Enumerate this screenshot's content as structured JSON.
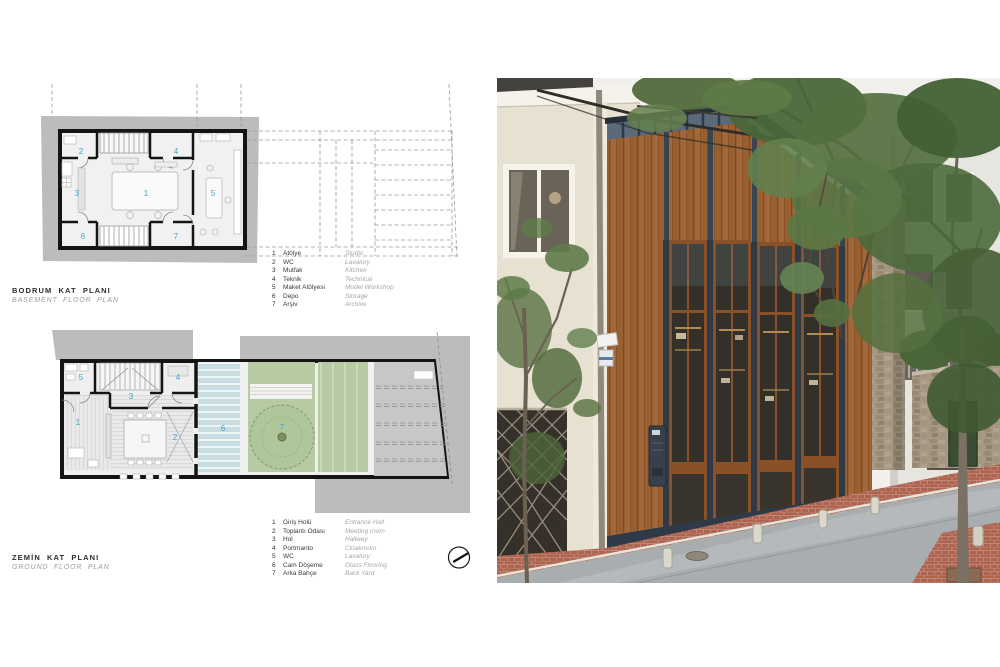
{
  "titles": {
    "basement_tr": "BODRUM KAT PLANI",
    "basement_en": "BASEMENT FLOOR PLAN",
    "ground_tr": "ZEMİN KAT PLANI",
    "ground_en": "GROUND FLOOR PLAN"
  },
  "basement_legend": [
    {
      "num": "1",
      "tr": "Atölye",
      "en": "Studio"
    },
    {
      "num": "2",
      "tr": "WC",
      "en": "Lavatory"
    },
    {
      "num": "3",
      "tr": "Mutfak",
      "en": "Kitchen"
    },
    {
      "num": "4",
      "tr": "Teknik",
      "en": "Technical"
    },
    {
      "num": "5",
      "tr": "Maket Atölyesi",
      "en": "Model Workshop"
    },
    {
      "num": "6",
      "tr": "Depo",
      "en": "Storage"
    },
    {
      "num": "7",
      "tr": "Arşiv",
      "en": "Archive"
    }
  ],
  "ground_legend": [
    {
      "num": "1",
      "tr": "Giriş Holü",
      "en": "Entrance Hall"
    },
    {
      "num": "2",
      "tr": "Toplantı Odası",
      "en": "Meeting room"
    },
    {
      "num": "3",
      "tr": "Hol",
      "en": "Hallway"
    },
    {
      "num": "4",
      "tr": "Portmanto",
      "en": "Cloakroom"
    },
    {
      "num": "5",
      "tr": "WC",
      "en": "Lavatory"
    },
    {
      "num": "6",
      "tr": "Cam Döşeme",
      "en": "Glass Flooring"
    },
    {
      "num": "7",
      "tr": "Arka Bahçe",
      "en": "Back Yard"
    }
  ],
  "rooms": {
    "basement": [
      "1",
      "2",
      "3",
      "4",
      "5",
      "6",
      "7"
    ],
    "ground": [
      "1",
      "2",
      "3",
      "4",
      "5",
      "6",
      "7"
    ]
  },
  "icons": {
    "north_arrow": "compass-north-arrow"
  },
  "colors": {
    "room_number": "#3da4c7",
    "site_gray": "#bcbcbc",
    "plan_wall": "#141414",
    "plan_floor": "#f0f0f0",
    "garden_green": "#b6cba3",
    "glass_floor_blue": "#c9dce1",
    "wood_facade": "#a2673a",
    "steel_navy": "#2e3a48",
    "brick_sidewalk": "#ad6450",
    "cream_wall": "#e7e1d1",
    "foliage_green": "#4d6a3c",
    "road_gray": "#a8adb0"
  }
}
